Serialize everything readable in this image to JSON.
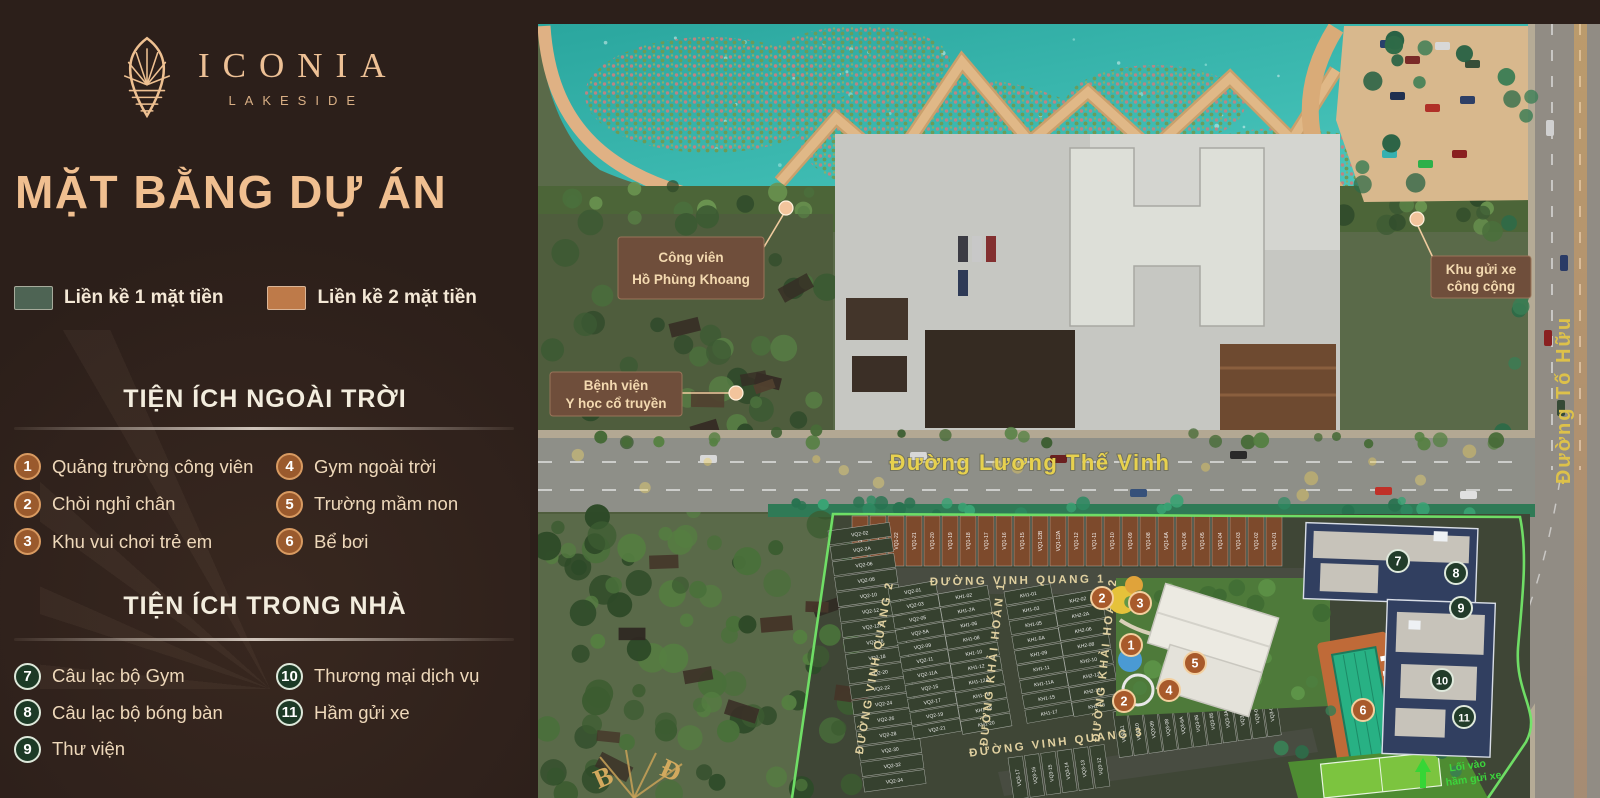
{
  "sidebar": {
    "logo": {
      "name": "ICONIA",
      "sub": "LAKESIDE"
    },
    "title": "MẶT BẰNG DỰ ÁN",
    "legend": {
      "items": [
        {
          "label": "Liền kề 1 mặt tiền",
          "color": "#4e6454"
        },
        {
          "label": "Liền kề 2 mặt tiền",
          "color": "#be7a49"
        }
      ]
    },
    "outdoor": {
      "title": "TIỆN ÍCH NGOÀI TRỜI",
      "items": [
        {
          "n": "1",
          "label": "Quảng trường công viên"
        },
        {
          "n": "2",
          "label": "Chòi nghỉ chân"
        },
        {
          "n": "3",
          "label": "Khu vui chơi trẻ em"
        },
        {
          "n": "4",
          "label": "Gym ngoài trời"
        },
        {
          "n": "5",
          "label": "Trường mầm non"
        },
        {
          "n": "6",
          "label": "Bể bơi"
        }
      ]
    },
    "indoor": {
      "title": "TIỆN ÍCH TRONG NHÀ",
      "items": [
        {
          "n": "7",
          "label": "Câu lạc bộ Gym"
        },
        {
          "n": "8",
          "label": "Câu lạc bộ bóng bàn"
        },
        {
          "n": "9",
          "label": "Thư viện"
        },
        {
          "n": "10",
          "label": "Thương mại dịch vụ"
        },
        {
          "n": "11",
          "label": "Hầm gửi xe"
        }
      ]
    }
  },
  "map": {
    "callouts": [
      {
        "line1": "Công viên",
        "line2": "Hồ Phùng Khoang"
      },
      {
        "line1": "Bệnh viện",
        "line2": "Y học cổ truyền"
      },
      {
        "line1": "Khu gửi xe",
        "line2": "công cộng"
      }
    ],
    "roads": {
      "main": "Đường Lương Thế Vinh",
      "to_huu": "Đường Tố Hữu",
      "vinh_quang_1": "ĐƯỜNG VINH QUANG 1",
      "vinh_quang_2": "ĐƯỜNG VINH QUANG 2",
      "vinh_quang_3": "ĐƯỜNG VINH QUANG 3",
      "khai_hoan_1": "ĐƯỜNG KHẢI HOÀN 1",
      "khai_hoan_2": "ĐƯỜNG KHẢI HOÀN 2"
    },
    "markers": [
      {
        "n": "1",
        "x": 601,
        "y": 645,
        "kind": "outdoor"
      },
      {
        "n": "2",
        "x": 572,
        "y": 598,
        "kind": "outdoor"
      },
      {
        "n": "2",
        "x": 594,
        "y": 701,
        "kind": "outdoor"
      },
      {
        "n": "3",
        "x": 610,
        "y": 603,
        "kind": "outdoor"
      },
      {
        "n": "4",
        "x": 639,
        "y": 690,
        "kind": "outdoor"
      },
      {
        "n": "5",
        "x": 665,
        "y": 663,
        "kind": "outdoor"
      },
      {
        "n": "6",
        "x": 833,
        "y": 710,
        "kind": "outdoor"
      },
      {
        "n": "7",
        "x": 868,
        "y": 561,
        "kind": "indoor"
      },
      {
        "n": "8",
        "x": 926,
        "y": 573,
        "kind": "indoor"
      },
      {
        "n": "9",
        "x": 931,
        "y": 608,
        "kind": "indoor"
      },
      {
        "n": "10",
        "x": 912,
        "y": 680,
        "kind": "indoor"
      },
      {
        "n": "11",
        "x": 934,
        "y": 717,
        "kind": "indoor"
      }
    ],
    "lots": {
      "vq1": [
        "VQ1-24",
        "VQ1-23",
        "VQ1-22",
        "VQ1-21",
        "VQ1-20",
        "VQ1-19",
        "VQ1-18",
        "VQ1-17",
        "VQ1-16",
        "VQ1-15",
        "VQ1-12B",
        "VQ1-12A",
        "VQ1-12",
        "VQ1-11",
        "VQ1-10",
        "VQ1-09",
        "VQ1-08",
        "VQ1-6A",
        "VQ1-06",
        "VQ1-05",
        "VQ1-04",
        "VQ1-03",
        "VQ1-02",
        "VQ1-01"
      ],
      "vq2_edge": [
        "VQ2-02",
        "VQ2-2A",
        "VQ2-06",
        "VQ2-08",
        "VQ2-10",
        "VQ2-12",
        "VQ2-12A",
        "VQ2-16",
        "VQ2-18",
        "VQ2-20",
        "VQ2-22",
        "VQ2-24",
        "VQ2-26",
        "VQ2-28",
        "VQ2-30",
        "VQ2-32",
        "VQ2-34"
      ],
      "block_a_left": [
        "VQ2-01",
        "VQ2-03",
        "VQ2-05",
        "VQ2-5A",
        "VQ2-09",
        "VQ2-11",
        "VQ2-11A",
        "VQ2-15",
        "VQ2-17",
        "VQ2-19",
        "VQ2-21"
      ],
      "block_a_right": [
        "KH1-02",
        "KH1-2A",
        "KH1-06",
        "KH1-08",
        "KH1-10",
        "KH1-12",
        "KH1-12A",
        "KH1-16",
        "KH1-18",
        "KH1-20"
      ],
      "block_b_left": [
        "KH1-01",
        "KH1-03",
        "KH1-05",
        "KH1-5A",
        "KH1-09",
        "KH1-11",
        "KH1-11A",
        "KH1-15",
        "KH1-17"
      ],
      "block_b_right": [
        "KH2-02",
        "KH2-2A",
        "KH2-06",
        "KH2-08",
        "KH2-10",
        "KH2-12",
        "KH2-12A",
        "KH2-16"
      ],
      "vq3_north": [
        "VQ3-11",
        "VQ3-10",
        "VQ3-09",
        "VQ3-08",
        "VQ3-6A",
        "VQ3-06",
        "VQ3-05",
        "VQ3-3A",
        "VQ3-03",
        "VQ3-02",
        "VQ3-01"
      ],
      "vq3_south": [
        "VQ3-17",
        "VQ3-16",
        "VQ3-15",
        "VQ3-14",
        "VQ3-13",
        "VQ3-12"
      ]
    },
    "compass": {
      "north": "B",
      "east": "Đ"
    },
    "entrance": {
      "line1": "Lối vào",
      "line2": "hầm gửi xe"
    },
    "colors": {
      "marker_outdoor": "#a85a2b",
      "marker_indoor": "#223c2a",
      "boundary": "#72e668"
    }
  }
}
